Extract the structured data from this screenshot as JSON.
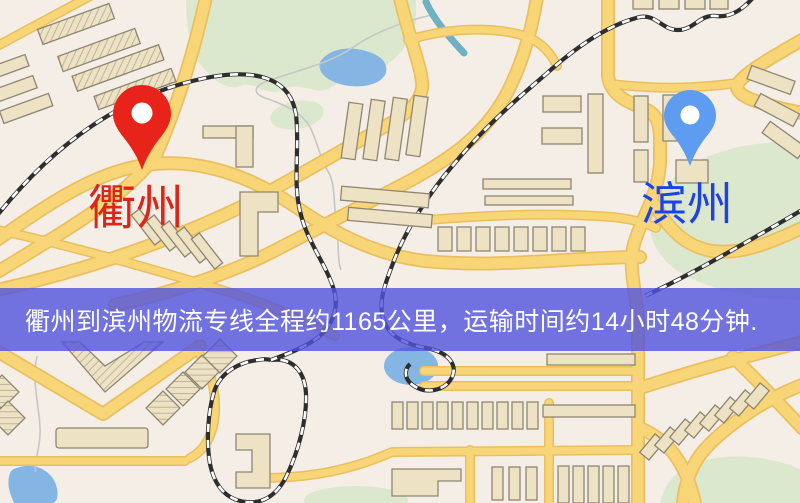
{
  "banner": {
    "text": "衢州到滨州物流专线全程约1165公里，运输时间约14小时48分钟.",
    "background": "rgba(80, 82, 221, 0.8)",
    "text_color": "#ffffff"
  },
  "route": {
    "origin": "衢州",
    "destination": "滨州",
    "distance_km": "1165",
    "duration": "14小时48分钟"
  },
  "markers": {
    "origin": {
      "label": "衢州",
      "pin_color": "#e8231a",
      "label_color": "#dd2418"
    },
    "destination": {
      "label": "滨州",
      "pin_color": "#5d9cf1",
      "label_color": "#1d43e6"
    }
  },
  "map_colors": {
    "background": "#f5eee6",
    "road": "#f8d678",
    "road_edge": "#eabf60",
    "building_fill": "#ede2c4",
    "building_stroke": "#8f8671",
    "park": "#dce8cd",
    "water": "#85b6e3",
    "railway": "#2e2e2e"
  }
}
